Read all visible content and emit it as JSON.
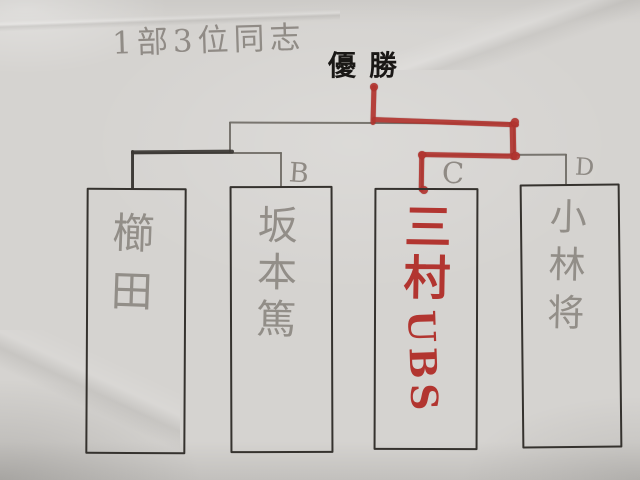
{
  "note_title": "1部3位同志",
  "champion_label": "優勝",
  "bracket": {
    "round_labels": {
      "B": "B",
      "C": "C",
      "D": "D"
    },
    "entries": [
      {
        "slot": "A",
        "seed_label": "",
        "name": "櫛田",
        "medium": "pencil"
      },
      {
        "slot": "B",
        "seed_label": "B",
        "name": "坂本篤",
        "medium": "pencil"
      },
      {
        "slot": "C",
        "seed_label": "C",
        "name_kanji": "三村",
        "name_latin": "UBS",
        "medium": "red-marker"
      },
      {
        "slot": "D",
        "seed_label": "D",
        "name": "小林将",
        "medium": "pencil"
      }
    ],
    "champion_path_from_slot": "C",
    "traced_semifinal_path_from_slot": "A"
  },
  "colors": {
    "paper": "#d5d3d0",
    "pencil_line": "#6e6a64",
    "trace_ink": "#3b3733",
    "box_ink": "#35322e",
    "pencil_text": "#87827c",
    "red_marker": "#b23530",
    "title_ink": "#1a1816"
  }
}
